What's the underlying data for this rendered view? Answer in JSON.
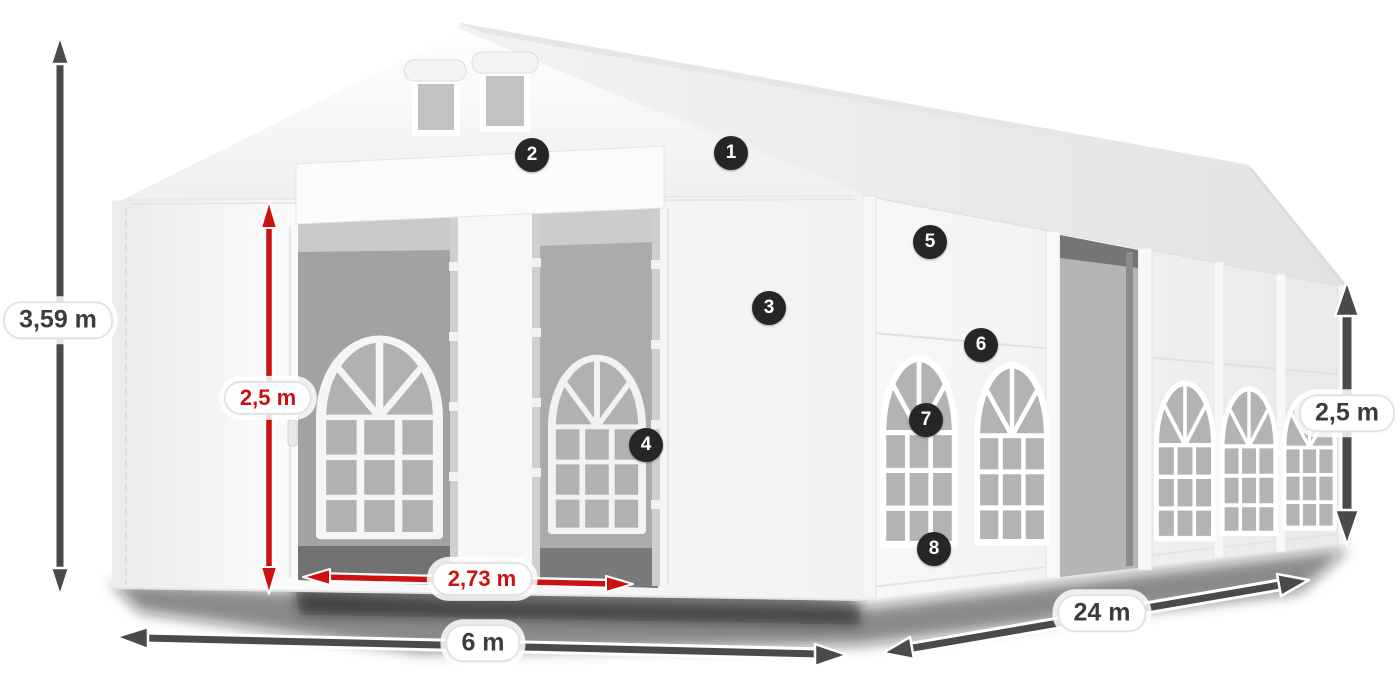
{
  "theme": {
    "dimension_arrow_color": "#4a4a4a",
    "highlight_arrow_color": "#cc1111",
    "dimension_text_color": "#3c3c3c",
    "highlight_text_color": "#cc1111",
    "badge_background": "#262626",
    "badge_text_color": "#ffffff",
    "label_background": "#ffffff"
  },
  "illustration": {
    "subject": "white-marquee-tent-3d-render",
    "background": "#ffffff"
  },
  "dimensions": {
    "total_height": {
      "label": "3,59 m",
      "style": "dark"
    },
    "inner_height": {
      "label": "2,5 m",
      "style": "red"
    },
    "entrance_width": {
      "label": "2,73 m",
      "style": "red"
    },
    "front_width": {
      "label": "6 m",
      "style": "dark"
    },
    "side_length": {
      "label": "24 m",
      "style": "dark"
    },
    "side_height": {
      "label": "2,5 m",
      "style": "dark"
    }
  },
  "callouts": [
    {
      "number": "1"
    },
    {
      "number": "2"
    },
    {
      "number": "3"
    },
    {
      "number": "4"
    },
    {
      "number": "5"
    },
    {
      "number": "6"
    },
    {
      "number": "7"
    },
    {
      "number": "8"
    }
  ]
}
